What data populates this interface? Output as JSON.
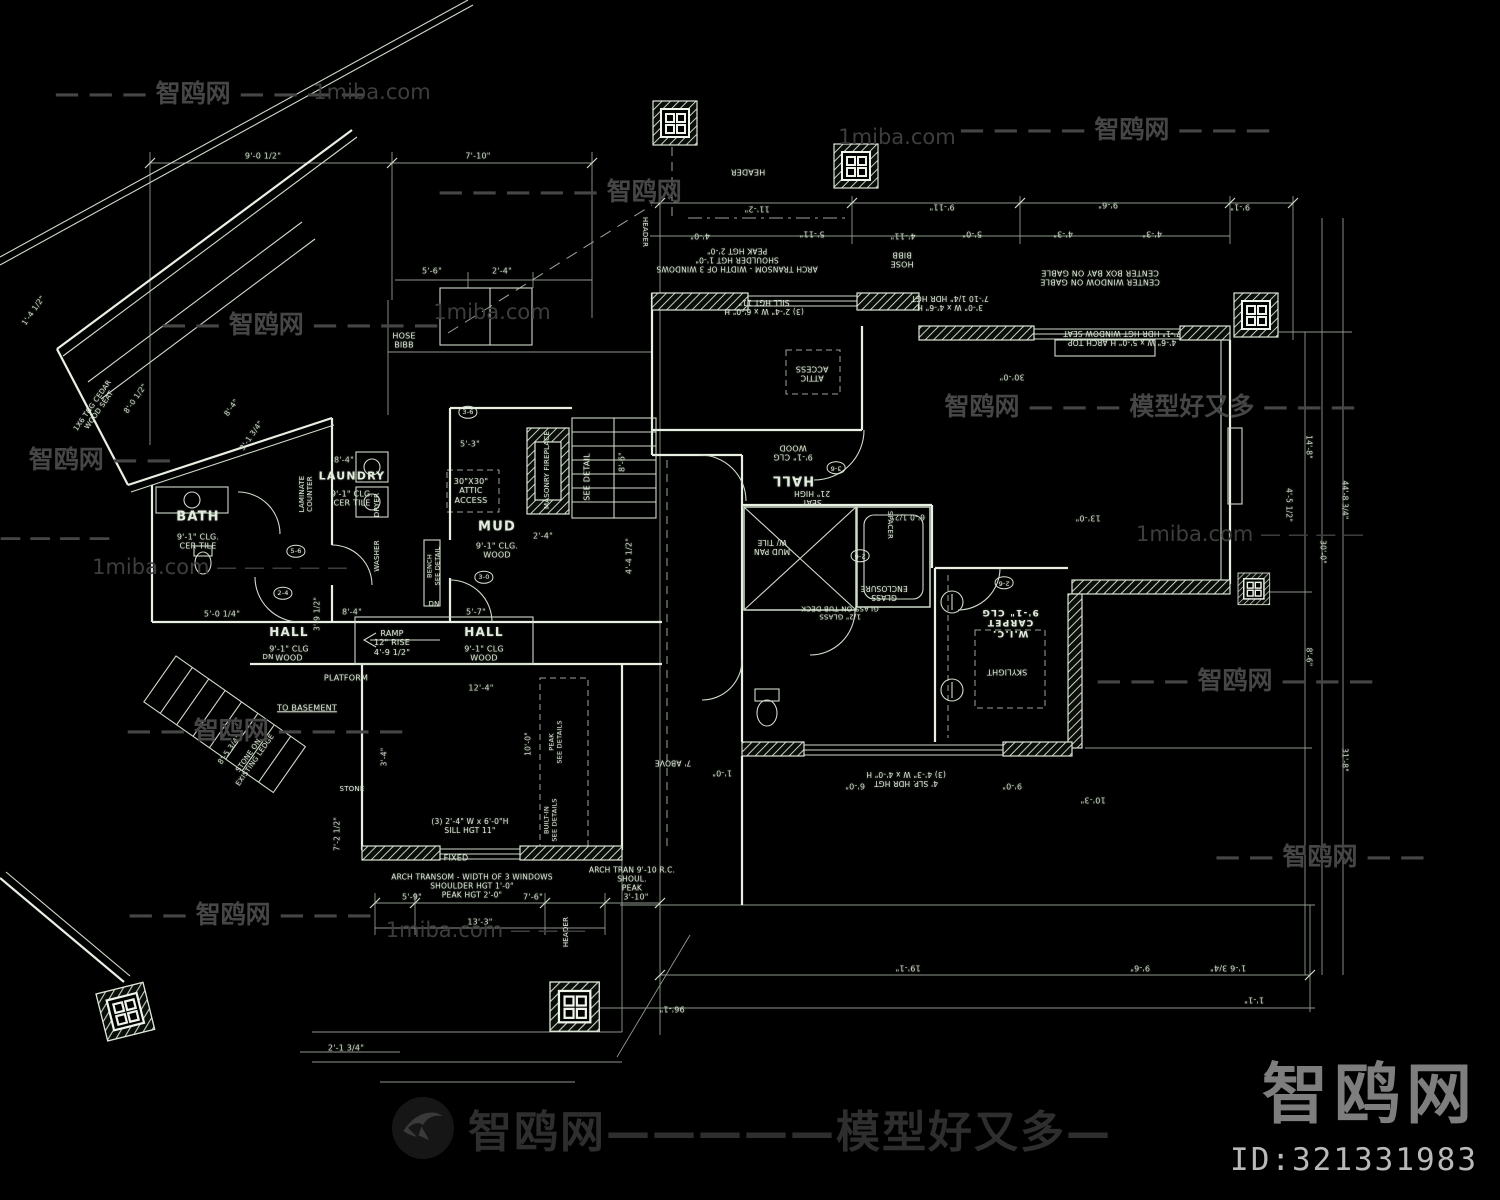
{
  "branding": {
    "logo_text": "智鸥网",
    "id_text": "ID:321331983",
    "footer_text": "智鸥网—————模型好又多—"
  },
  "watermarks": [
    {
      "t": "— — — 智鸥网 — — — —",
      "x": 210,
      "y": 92,
      "s": 25
    },
    {
      "t": "1miba.com",
      "x": 372,
      "y": 92,
      "s": 21,
      "site": true
    },
    {
      "t": "— — — — 智鸥网 — — —",
      "x": 1115,
      "y": 128,
      "s": 25
    },
    {
      "t": "1miba.com",
      "x": 897,
      "y": 137,
      "s": 21,
      "site": true
    },
    {
      "t": "— — — — — 智鸥网",
      "x": 560,
      "y": 190,
      "s": 25
    },
    {
      "t": "— — 智鸥网 — — — —",
      "x": 300,
      "y": 323,
      "s": 25
    },
    {
      "t": "1miba.com",
      "x": 492,
      "y": 312,
      "s": 21,
      "site": true
    },
    {
      "t": "智鸥网 — — — 模型好又多 — — —",
      "x": 1150,
      "y": 405,
      "s": 25
    },
    {
      "t": "智鸥网 — —",
      "x": 100,
      "y": 458,
      "s": 25
    },
    {
      "t": "1miba.com — — — —",
      "x": 1250,
      "y": 534,
      "s": 21,
      "site": true
    },
    {
      "t": "— — — —",
      "x": 55,
      "y": 538,
      "s": 22
    },
    {
      "t": "1miba.com — — — — —",
      "x": 220,
      "y": 567,
      "s": 21,
      "site": true
    },
    {
      "t": "— — 智鸥网 — — — —",
      "x": 265,
      "y": 729,
      "s": 25
    },
    {
      "t": "— — — 智鸥网 — — —",
      "x": 1235,
      "y": 679,
      "s": 25
    },
    {
      "t": "— — 智鸥网 — — —",
      "x": 250,
      "y": 913,
      "s": 25
    },
    {
      "t": "1miba.com — — —",
      "x": 486,
      "y": 930,
      "s": 21,
      "site": true
    },
    {
      "t": "— — 智鸥网 — —",
      "x": 1320,
      "y": 855,
      "s": 25
    }
  ],
  "plan": {
    "labels": [
      {
        "t": "BATH",
        "x": 198,
        "y": 517,
        "s": 13,
        "c": "room"
      },
      {
        "t": "9'-1\" CLG.\nCER TILE",
        "x": 198,
        "y": 542,
        "s": 8,
        "c": "sub"
      },
      {
        "t": "LAUNDRY",
        "x": 352,
        "y": 477,
        "s": 11,
        "c": "room"
      },
      {
        "t": "9'-1\" CLG.\nCER TILE",
        "x": 352,
        "y": 499,
        "s": 8,
        "c": "sub"
      },
      {
        "t": "MUD",
        "x": 497,
        "y": 527,
        "s": 13,
        "c": "room"
      },
      {
        "t": "9'-1\" CLG.\nWOOD",
        "x": 497,
        "y": 551,
        "s": 8,
        "c": "sub"
      },
      {
        "t": "HALL",
        "x": 289,
        "y": 632,
        "s": 12,
        "c": "room"
      },
      {
        "t": "9'-1\" CLG\nWOOD",
        "x": 289,
        "y": 654,
        "s": 8,
        "c": "sub"
      },
      {
        "t": "HALL",
        "x": 484,
        "y": 632,
        "s": 12,
        "c": "room"
      },
      {
        "t": "9'-1\" CLG\nWOOD",
        "x": 484,
        "y": 654,
        "s": 8,
        "c": "sub"
      },
      {
        "t": "HALL",
        "x": 793,
        "y": 480,
        "r": 180,
        "s": 13,
        "c": "room"
      },
      {
        "t": "9'-1\" CLG\nWOOD",
        "x": 793,
        "y": 452,
        "r": 180,
        "s": 8,
        "c": "sub"
      },
      {
        "t": "W.I.C.\nCARPET\n9'-1\" CLG",
        "x": 1010,
        "y": 622,
        "r": 180,
        "s": 9,
        "c": "room"
      },
      {
        "t": "HOSE\nBIBB",
        "x": 404,
        "y": 341,
        "s": 8
      },
      {
        "t": "LAMINATE\nCOUNTER",
        "x": 306,
        "y": 494,
        "r": -90,
        "s": 7
      },
      {
        "t": "DRYER",
        "x": 377,
        "y": 505,
        "r": -90,
        "s": 7
      },
      {
        "t": "WASHER",
        "x": 377,
        "y": 556,
        "r": -90,
        "s": 7
      },
      {
        "t": "30\"X30\"\nATTIC\nACCESS",
        "x": 471,
        "y": 491,
        "s": 8
      },
      {
        "t": "SEE DETAIL",
        "x": 587,
        "y": 477,
        "r": -90,
        "s": 8
      },
      {
        "t": "MASONRY FIREPLACE",
        "x": 547,
        "y": 470,
        "r": -90,
        "s": 7
      },
      {
        "t": "RAMP\n12\" RISE\n4'-9 1/2\"",
        "x": 392,
        "y": 643,
        "s": 8
      },
      {
        "t": "PLATFORM",
        "x": 346,
        "y": 678,
        "s": 8
      },
      {
        "t": "TO BASEMENT",
        "x": 307,
        "y": 708,
        "s": 8,
        "u": true
      },
      {
        "t": "STONE ON\nEXISTING LEDGE",
        "x": 252,
        "y": 758,
        "r": -55,
        "s": 7
      },
      {
        "t": "STONE",
        "x": 352,
        "y": 789,
        "s": 7
      },
      {
        "t": "FIXED",
        "x": 456,
        "y": 858,
        "s": 8
      },
      {
        "t": "(3) 2'-4\" W x 6'-0\"H\nSILL HGT 11\"",
        "x": 470,
        "y": 827,
        "s": 7.5
      },
      {
        "t": "ARCH TRANSOM - WIDTH OF 3 WINDOWS\nSHOULDER HGT 1'-0\"\nPEAK HGT 2'-0\"",
        "x": 472,
        "y": 887,
        "s": 7.5
      },
      {
        "t": "ARCH TRAN 9'-10 R.C.\nSHOUL.\nPEAK",
        "x": 632,
        "y": 880,
        "s": 7.5
      },
      {
        "t": "HEADER",
        "x": 566,
        "y": 932,
        "r": -90,
        "s": 7
      },
      {
        "t": "HEADER",
        "x": 645,
        "y": 232,
        "r": 90,
        "s": 7
      },
      {
        "t": "BENCH\nSEE DETAIL",
        "x": 434,
        "y": 566,
        "r": -90,
        "s": 6.5
      },
      {
        "t": "BUILT-IN\nSEE DETAILS",
        "x": 551,
        "y": 820,
        "r": -90,
        "s": 6.5
      },
      {
        "t": "PEAK\nSEE DETAILS",
        "x": 556,
        "y": 742,
        "r": -90,
        "s": 6.5
      },
      {
        "t": "DN",
        "x": 268,
        "y": 657,
        "s": 7
      },
      {
        "t": "DN",
        "x": 434,
        "y": 604,
        "s": 7
      },
      {
        "t": "1X6 T&G CEDAR\nWOOD SEAT",
        "x": 96,
        "y": 408,
        "r": -55,
        "s": 7
      },
      {
        "t": "HEADER",
        "x": 748,
        "y": 172,
        "r": 180,
        "s": 8
      },
      {
        "t": "ARCH TRANSOM - WIDTH OF 3 WINDOWS\nSHOULDER HGT 1'-0\"\nPEAK HGT 2'-0\"",
        "x": 737,
        "y": 259,
        "r": 180,
        "s": 7.5
      },
      {
        "t": "(3) 2'-4\" W x 6'-0\" H\nSILL HGT 11\"",
        "x": 764,
        "y": 306,
        "r": 180,
        "s": 7.5
      },
      {
        "t": "HOSE\nBIBB",
        "x": 902,
        "y": 259,
        "r": 180,
        "s": 8
      },
      {
        "t": "CENTER WINDOW ON GABLE\nCENTER BOX BAY ON GABLE",
        "x": 1100,
        "y": 277,
        "r": 180,
        "s": 8
      },
      {
        "t": "3'-0\" W x 4'-6\" H\n7'-10 1/4\" HDR HGT",
        "x": 950,
        "y": 302,
        "r": 180,
        "s": 7.5
      },
      {
        "t": "4'-6\" W x 5'-0\" H ARCH TOP\n7'-1\" HDR HGT  WINDOW SEAT",
        "x": 1122,
        "y": 337,
        "r": 180,
        "s": 7.5
      },
      {
        "t": "ATTIC\nACCESS",
        "x": 812,
        "y": 373,
        "r": 180,
        "s": 8
      },
      {
        "t": "SEAT\n21\" HIGH",
        "x": 812,
        "y": 497,
        "r": 180,
        "s": 7.5
      },
      {
        "t": "MUD PAN\nW/ TILE",
        "x": 772,
        "y": 546,
        "r": 180,
        "s": 7.5
      },
      {
        "t": "GLASS\nENCLOSURE",
        "x": 884,
        "y": 592,
        "r": 180,
        "s": 7.5
      },
      {
        "t": "1/2\" GLASS\nGLASS ON TUB DECK",
        "x": 840,
        "y": 612,
        "r": 180,
        "s": 7
      },
      {
        "t": "SPACER",
        "x": 890,
        "y": 525,
        "r": 90,
        "s": 7
      },
      {
        "t": "SKYLIGHT",
        "x": 1007,
        "y": 672,
        "r": 180,
        "s": 8
      },
      {
        "t": "7' ABOVE",
        "x": 673,
        "y": 762,
        "r": 180,
        "s": 7.5
      },
      {
        "t": "4' SLP. HDR HGT\n(3) 4'-3\" W x 4'-0\" H",
        "x": 906,
        "y": 778,
        "r": 180,
        "s": 7.5
      },
      {
        "t": "9'-0 1/2\"",
        "x": 263,
        "y": 156,
        "s": 8,
        "c": "dim"
      },
      {
        "t": "7'-10\"",
        "x": 478,
        "y": 156,
        "s": 8,
        "c": "dim"
      },
      {
        "t": "5'-6\"",
        "x": 432,
        "y": 271,
        "s": 8,
        "c": "dim"
      },
      {
        "t": "2'-4\"",
        "x": 502,
        "y": 271,
        "s": 8,
        "c": "dim"
      },
      {
        "t": "8'-4\"",
        "x": 344,
        "y": 460,
        "s": 8,
        "c": "dim"
      },
      {
        "t": "5'-3\"",
        "x": 470,
        "y": 444,
        "s": 8,
        "c": "dim"
      },
      {
        "t": "2'-4\"",
        "x": 543,
        "y": 536,
        "s": 8,
        "c": "dim"
      },
      {
        "t": "4'-4 1/2\"",
        "x": 629,
        "y": 556,
        "r": -90,
        "s": 8,
        "c": "dim"
      },
      {
        "t": "8'-6\"",
        "x": 622,
        "y": 462,
        "r": -90,
        "s": 8,
        "c": "dim"
      },
      {
        "t": "8'-4\"",
        "x": 352,
        "y": 612,
        "s": 8,
        "c": "dim"
      },
      {
        "t": "5'-7\"",
        "x": 476,
        "y": 612,
        "s": 8,
        "c": "dim"
      },
      {
        "t": "12'-4\"",
        "x": 481,
        "y": 688,
        "s": 8,
        "c": "dim"
      },
      {
        "t": "5'-0 1/4\"",
        "x": 222,
        "y": 614,
        "s": 8,
        "c": "dim"
      },
      {
        "t": "3'-1 3/4\"",
        "x": 252,
        "y": 436,
        "r": -55,
        "s": 7.5,
        "c": "dim"
      },
      {
        "t": "8'-4\"",
        "x": 232,
        "y": 408,
        "r": -55,
        "s": 7.5,
        "c": "dim"
      },
      {
        "t": "1'-4 1/2\"",
        "x": 34,
        "y": 311,
        "r": -55,
        "s": 7.5,
        "c": "dim"
      },
      {
        "t": "8'-0 1/2\"",
        "x": 136,
        "y": 399,
        "r": -55,
        "s": 7.5,
        "c": "dim"
      },
      {
        "t": "8'-5 3/4\"",
        "x": 230,
        "y": 750,
        "r": -55,
        "s": 7.5,
        "c": "dim"
      },
      {
        "t": "5'-9\"",
        "x": 412,
        "y": 897,
        "s": 8,
        "c": "dim"
      },
      {
        "t": "7'-6\"",
        "x": 533,
        "y": 897,
        "s": 8,
        "c": "dim"
      },
      {
        "t": "3'-10\"",
        "x": 636,
        "y": 897,
        "s": 8,
        "c": "dim"
      },
      {
        "t": "13'-3\"",
        "x": 480,
        "y": 922,
        "s": 8,
        "c": "dim"
      },
      {
        "t": "2'-1 3/4\"",
        "x": 346,
        "y": 1048,
        "s": 8,
        "c": "dim"
      },
      {
        "t": "7'-2 1/2\"",
        "x": 338,
        "y": 834,
        "r": -90,
        "s": 7.5,
        "c": "dim"
      },
      {
        "t": "3'-4\"",
        "x": 385,
        "y": 757,
        "r": -90,
        "s": 7.5,
        "c": "dim"
      },
      {
        "t": "10'-0\"",
        "x": 529,
        "y": 744,
        "r": -90,
        "s": 7.5,
        "c": "dim"
      },
      {
        "t": "3'-9 1/2\"",
        "x": 318,
        "y": 614,
        "r": -90,
        "s": 7.5,
        "c": "dim"
      },
      {
        "t": "11'-2\"",
        "x": 757,
        "y": 209,
        "r": 180,
        "s": 8,
        "c": "dim"
      },
      {
        "t": "9'-11\"",
        "x": 942,
        "y": 207,
        "r": 180,
        "s": 8,
        "c": "dim"
      },
      {
        "t": "9'-6\"",
        "x": 1108,
        "y": 205,
        "r": 180,
        "s": 8,
        "c": "dim"
      },
      {
        "t": "9'-1\"",
        "x": 1240,
        "y": 207,
        "r": 180,
        "s": 8,
        "c": "dim"
      },
      {
        "t": "4'-0\"",
        "x": 700,
        "y": 236,
        "r": 180,
        "s": 8,
        "c": "dim"
      },
      {
        "t": "5'-11\"",
        "x": 812,
        "y": 234,
        "r": 180,
        "s": 8,
        "c": "dim"
      },
      {
        "t": "4'-11\"",
        "x": 903,
        "y": 236,
        "r": 180,
        "s": 8,
        "c": "dim"
      },
      {
        "t": "5'-0\"",
        "x": 972,
        "y": 234,
        "r": 180,
        "s": 8,
        "c": "dim"
      },
      {
        "t": "4'-3\"",
        "x": 1063,
        "y": 234,
        "r": 180,
        "s": 8,
        "c": "dim"
      },
      {
        "t": "4'-3\"",
        "x": 1152,
        "y": 234,
        "r": 180,
        "s": 8,
        "c": "dim"
      },
      {
        "t": "30'-0\"",
        "x": 1012,
        "y": 377,
        "r": 180,
        "s": 8,
        "c": "dim"
      },
      {
        "t": "6'-0 1/2\"",
        "x": 908,
        "y": 516,
        "r": 180,
        "s": 7.5,
        "c": "dim"
      },
      {
        "t": "13'-0\"",
        "x": 1088,
        "y": 518,
        "r": 180,
        "s": 8,
        "c": "dim"
      },
      {
        "t": "19'-1\"",
        "x": 908,
        "y": 968,
        "r": 180,
        "s": 8,
        "c": "dim"
      },
      {
        "t": "9'-6\"",
        "x": 1140,
        "y": 968,
        "r": 180,
        "s": 8,
        "c": "dim"
      },
      {
        "t": "1'-6 3/4\"",
        "x": 1228,
        "y": 968,
        "r": 180,
        "s": 8,
        "c": "dim"
      },
      {
        "t": "1'-1\"",
        "x": 1254,
        "y": 1000,
        "r": 180,
        "s": 8,
        "c": "dim"
      },
      {
        "t": "96'-1\"",
        "x": 672,
        "y": 1009,
        "r": 180,
        "s": 8,
        "c": "dim"
      },
      {
        "t": "6'-0\"",
        "x": 855,
        "y": 786,
        "r": 180,
        "s": 8,
        "c": "dim"
      },
      {
        "t": "9'-0\"",
        "x": 1012,
        "y": 786,
        "r": 180,
        "s": 8,
        "c": "dim"
      },
      {
        "t": "10'-3\"",
        "x": 1093,
        "y": 800,
        "r": 180,
        "s": 8,
        "c": "dim"
      },
      {
        "t": "1'-0\"",
        "x": 722,
        "y": 773,
        "r": 180,
        "s": 8,
        "c": "dim"
      },
      {
        "t": "14'-8\"",
        "x": 1308,
        "y": 447,
        "r": 90,
        "s": 7.5,
        "c": "dim"
      },
      {
        "t": "4'-5 1/2\"",
        "x": 1288,
        "y": 505,
        "r": 90,
        "s": 7.5,
        "c": "dim"
      },
      {
        "t": "44'-8 3/4\"",
        "x": 1344,
        "y": 500,
        "r": 90,
        "s": 7.5,
        "c": "dim"
      },
      {
        "t": "30'-0\"",
        "x": 1322,
        "y": 552,
        "r": 90,
        "s": 7.5,
        "c": "dim"
      },
      {
        "t": "8'-6\"",
        "x": 1308,
        "y": 657,
        "r": 90,
        "s": 7.5,
        "c": "dim"
      },
      {
        "t": "31'-8\"",
        "x": 1344,
        "y": 760,
        "r": 90,
        "s": 7.5,
        "c": "dim"
      },
      {
        "t": "2-4",
        "x": 283,
        "y": 593,
        "s": 6.5,
        "c": "tag"
      },
      {
        "t": "5-6",
        "x": 296,
        "y": 551,
        "s": 6.5,
        "c": "tag"
      },
      {
        "t": "3-6",
        "x": 468,
        "y": 412,
        "s": 6.5,
        "c": "tag"
      },
      {
        "t": "3-0",
        "x": 484,
        "y": 577,
        "s": 6.5,
        "c": "tag"
      },
      {
        "t": "3-6",
        "x": 836,
        "y": 468,
        "r": 180,
        "s": 6.5,
        "c": "tag"
      },
      {
        "t": "2-6",
        "x": 860,
        "y": 556,
        "r": 180,
        "s": 6.5,
        "c": "tag"
      },
      {
        "t": "2-6",
        "x": 1004,
        "y": 583,
        "r": 180,
        "s": 6.5,
        "c": "tag"
      }
    ]
  }
}
